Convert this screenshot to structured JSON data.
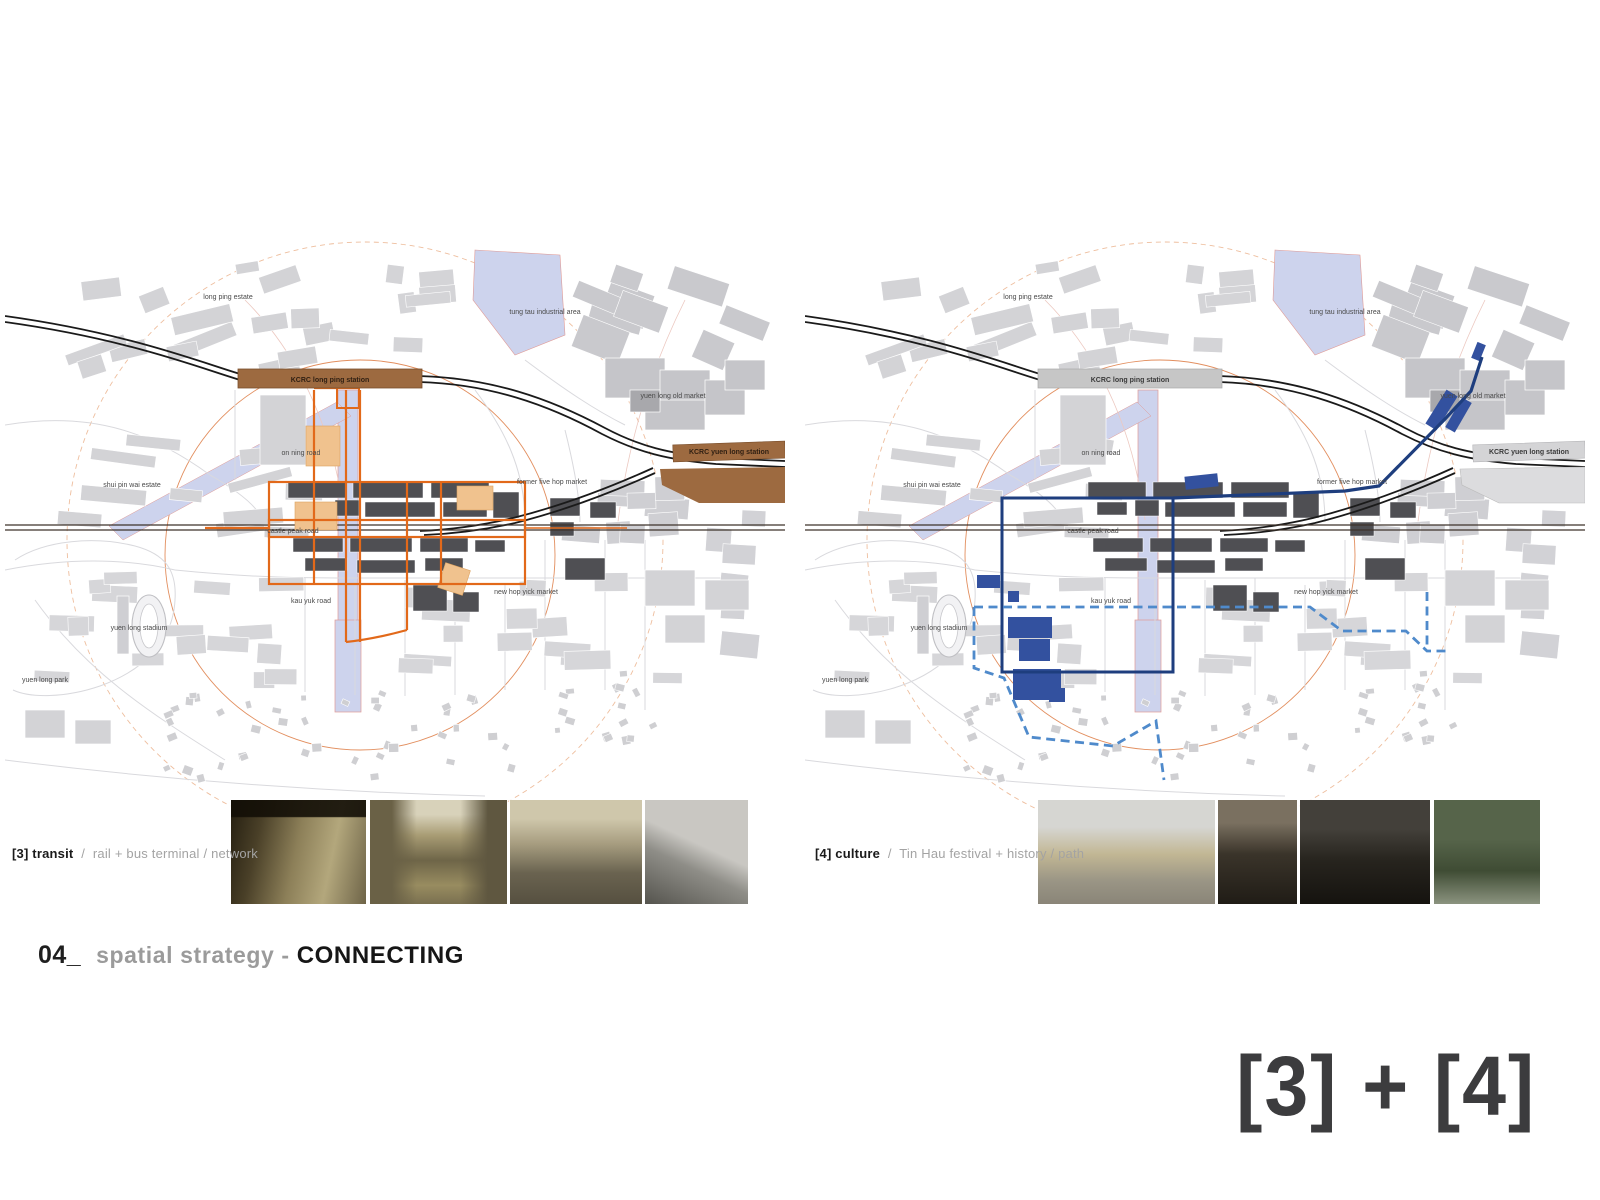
{
  "title": {
    "number": "04_",
    "text": "spatial strategy - ",
    "emphasis": "CONNECTING"
  },
  "summary_tag": "[3] + [4]",
  "panels": [
    {
      "id": "transit",
      "caption": {
        "tag": "[3] transit",
        "separator": "/",
        "detail": "rail + bus terminal / network"
      },
      "colors": {
        "station_bar": "#9d6a40",
        "network": "#e2691a",
        "block_fill": "#f0c28e"
      },
      "photos": [
        "rail-station-platform",
        "street-with-trams-and-buses",
        "market-street-crowd",
        "residential-towers-skyline"
      ]
    },
    {
      "id": "culture",
      "caption": {
        "tag": "[4] culture",
        "separator": "/",
        "detail": "Tin Hau festival + history / path"
      },
      "colors": {
        "station_bar": "#c6c6c6",
        "boundary": "#1e3e7e",
        "block_fill": "#33519f",
        "path_dashed": "#4f8acb"
      },
      "photos": [
        "tin-hau-festival-parade",
        "old-temple-doorway",
        "temple-roof-detail",
        "tree-lined-market-street"
      ]
    }
  ],
  "map_labels": [
    {
      "text": "long ping estate",
      "x": 223,
      "y": 59
    },
    {
      "text": "tung tau industrial area",
      "x": 540,
      "y": 74
    },
    {
      "text": "yuen long old market",
      "x": 668,
      "y": 158
    },
    {
      "text": "on ning road",
      "x": 296,
      "y": 215
    },
    {
      "text": "shui pin wai estate",
      "x": 127,
      "y": 247
    },
    {
      "text": "former five hop market",
      "x": 547,
      "y": 244
    },
    {
      "text": "castle peak road",
      "x": 288,
      "y": 293
    },
    {
      "text": "new hop yick market",
      "x": 521,
      "y": 354
    },
    {
      "text": "kau yuk road",
      "x": 306,
      "y": 363
    },
    {
      "text": "yuen long stadium",
      "x": 134,
      "y": 390
    },
    {
      "text": "yuen long park",
      "x": 40,
      "y": 442
    }
  ],
  "station_labels": [
    {
      "text": "KCRC long ping station",
      "x": 325,
      "y": 142
    },
    {
      "text": "KCRC  yuen long station",
      "x": 724,
      "y": 214
    }
  ],
  "base_colors": {
    "water": "#cdd3ed",
    "water_edge": "#e09a95",
    "building_light": "#d3d3d6",
    "building_mid": "#c5c5c9",
    "building_dark": "#4f4f53",
    "rail": "#1a1a1a",
    "road_dark": "#3d332b",
    "road_faint": "#d9d9dd",
    "road_pink": "#ecc8c0",
    "radius_ring": "#dd7a42",
    "radius_ring_outer": "#e8a87e",
    "label": "#4a4a4a"
  }
}
